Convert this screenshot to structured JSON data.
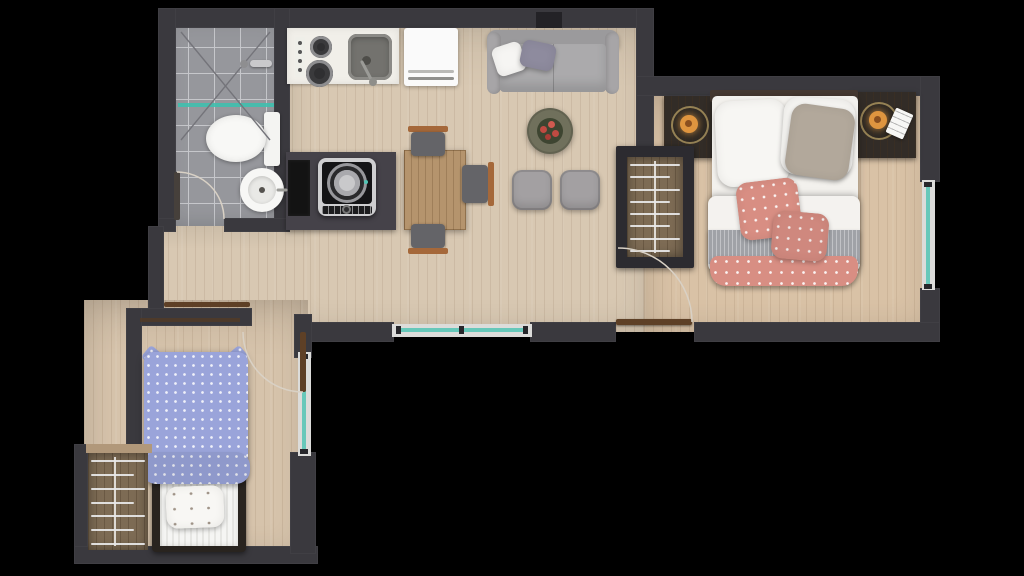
{
  "meta": {
    "scene": "apartment-floor-plan",
    "view": "top-down-render",
    "canvas": {
      "width": 1024,
      "height": 576
    }
  },
  "colors": {
    "outside": "#000000",
    "wall": "#3a393e",
    "wall_dark": "#2d2c31",
    "floor_main": "#d8c8b2",
    "floor_bedroom": "#d9c2a6",
    "floor_bed2": "#d6c3ab",
    "tile": "#96979c",
    "grout": "#c6c7cb",
    "counter": "#f1efe9",
    "fridge": "#fafafa",
    "sofa": "#a7a5a7",
    "sofa_back": "#9b9a9c",
    "pouf": "#a3a0a2",
    "table_wood": "#b5946d",
    "chair_seat": "#646468",
    "chair_wood": "#a5683a",
    "dark_counter": "#454249",
    "black_cabinet": "#131313",
    "washer_frame": "#cfcfd1",
    "washer_face": "#141416",
    "teal": "#52c4b4",
    "window_frame": "#dcdcda",
    "door_wood": "#5e4026",
    "arc": "#d9d1c5",
    "nightstand": "#322c27",
    "lamp_glow": "#df953f",
    "bed_white": "#f3f1ed",
    "pillow_taupe": "#b2a89b",
    "pink": "#d88e83",
    "blanket": "#a0a2a7",
    "wardrobe_wood": "#7d6b54",
    "wardrobe_frame": "#2c2b30",
    "hanger": "#e9e9ea",
    "blue": "#9aa4da",
    "blue_deep": "#8d97d2",
    "mattress": "#f5f5f3",
    "coffee_table": "#70705c",
    "plant_leaf": "#3e4531",
    "flower": "#c04a42",
    "shower_screen": "#3fbfae"
  },
  "rooms": {
    "bathroom": {
      "id": "bathroom",
      "fixtures": [
        "shower",
        "shower-glass-screen",
        "toilet",
        "washbasin",
        "swing-door"
      ]
    },
    "kitchen": {
      "id": "kitchen",
      "fixtures": [
        "two-burner-cooktop",
        "kitchen-sink",
        "refrigerator",
        "washing-machine",
        "tall-cabinet"
      ]
    },
    "living_dining": {
      "id": "living-dining",
      "fixtures": [
        "sofa",
        "coffee-table-with-plant",
        "dining-table",
        "poufs",
        "entrance-door",
        "window"
      ],
      "chair_count": 3,
      "pouf_count": 2
    },
    "bedroom_main": {
      "id": "bedroom-main",
      "fixtures": [
        "double-bed",
        "nightstand-left",
        "nightstand-right",
        "table-lamps",
        "notepad",
        "open-wardrobe",
        "window"
      ],
      "pillow_counts": {
        "white": 2,
        "taupe": 1,
        "pink": 2
      }
    },
    "bedroom_small": {
      "id": "bedroom-small",
      "fixtures": [
        "single-bed",
        "open-wardrobe",
        "sliding-door-panel",
        "swing-door",
        "window"
      ]
    }
  },
  "wardrobes": {
    "main": {
      "hangers": 8
    },
    "small": {
      "hangers": 7
    }
  },
  "windows": {
    "count": 3
  },
  "doors": {
    "swing": 3,
    "sliding": 1
  }
}
